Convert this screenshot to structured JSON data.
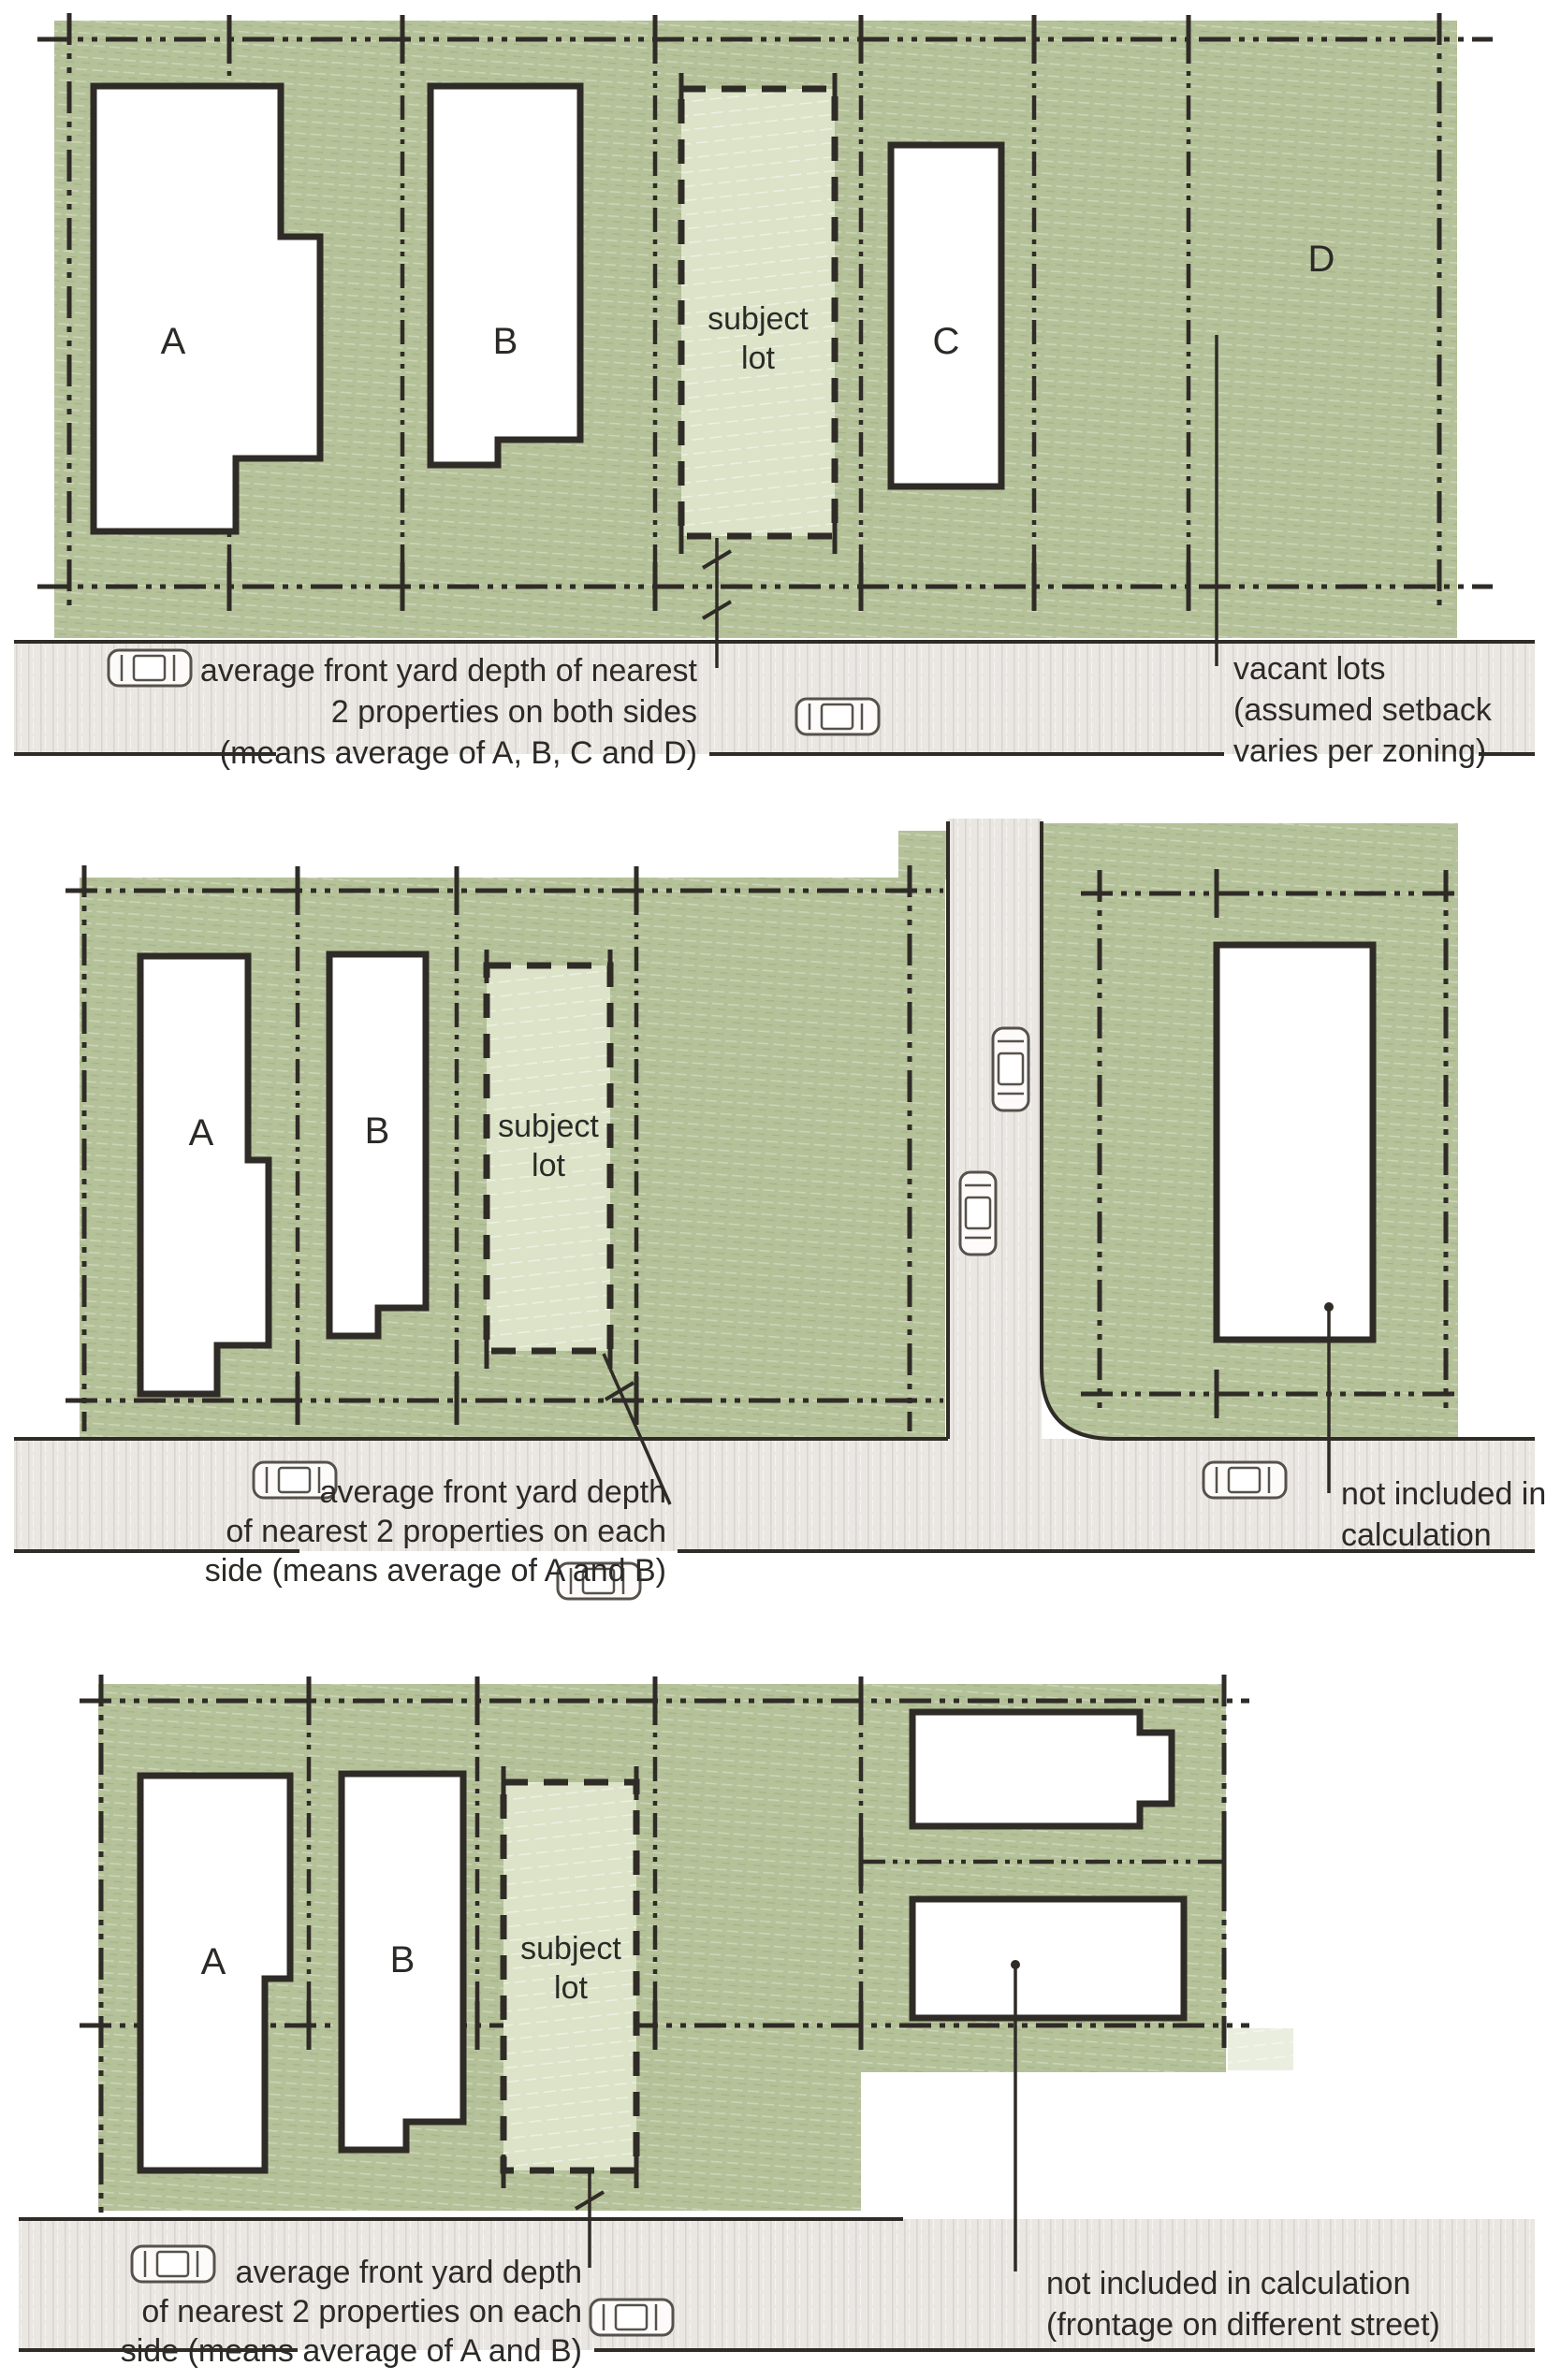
{
  "diagram_title": "front yard setback averaging diagrams",
  "colors": {
    "block_green": "#b5c199",
    "subject_green": "#dce3c8",
    "street_gray": "#eae6e2",
    "ink": "#2f2b26"
  },
  "panel1": {
    "labels": {
      "a": "A",
      "b": "B",
      "c": "C",
      "d": "D"
    },
    "subject": {
      "line1": "subject",
      "line2": "lot"
    },
    "caption_main": {
      "l1": "average front yard depth of nearest",
      "l2": "2 properties on both sides",
      "l3": "(means average of A, B, C and D)"
    },
    "caption_side": {
      "l1": "vacant lots",
      "l2": "(assumed setback",
      "l3": "varies per zoning)"
    }
  },
  "panel2": {
    "labels": {
      "a": "A",
      "b": "B"
    },
    "subject": {
      "line1": "subject",
      "line2": "lot"
    },
    "caption_main": {
      "l1": "average front yard depth",
      "l2": "of nearest 2 properties on each",
      "l3": "side (means average of A and B)"
    },
    "caption_side": {
      "l1": "not included in",
      "l2": "calculation"
    }
  },
  "panel3": {
    "labels": {
      "a": "A",
      "b": "B"
    },
    "subject": {
      "line1": "subject",
      "line2": "lot"
    },
    "caption_main": {
      "l1": "average front yard depth",
      "l2": "of nearest 2 properties on each",
      "l3": "side (means average of A and B)"
    },
    "caption_side": {
      "l1": "not included in calculation",
      "l2": "(frontage on different street)"
    }
  }
}
